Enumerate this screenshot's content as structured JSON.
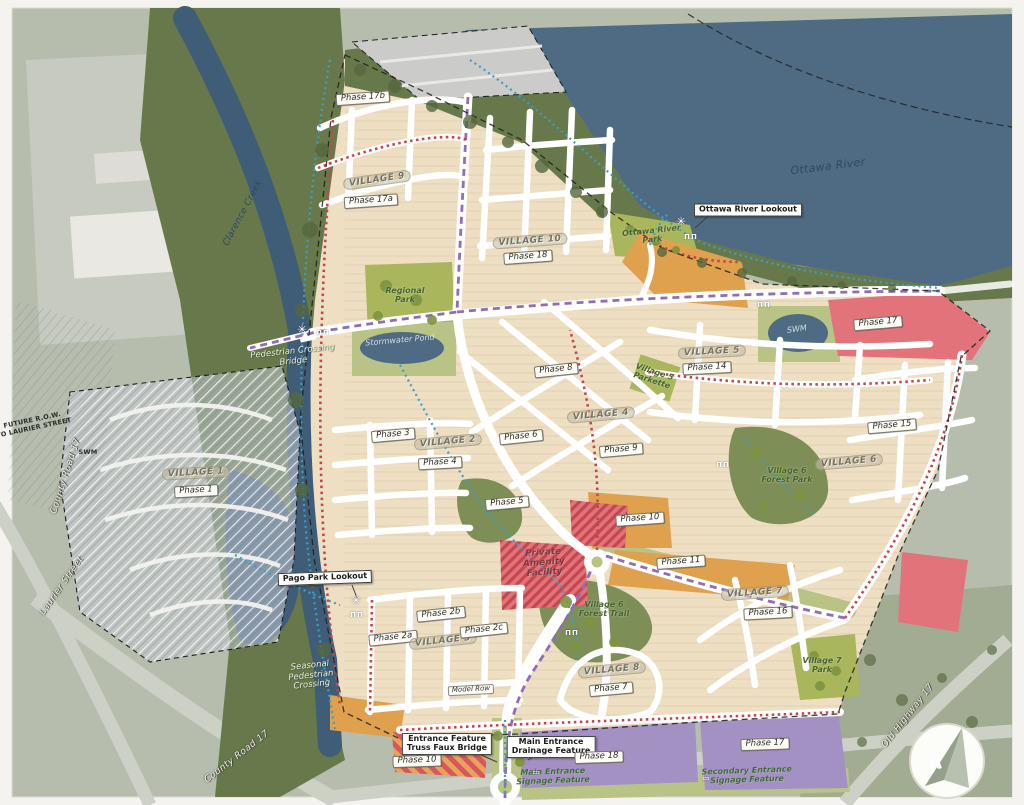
{
  "map": {
    "title": "Community master plan with villages and phases",
    "north_arrow_label": "N",
    "colors": {
      "page": "#f4f3ef",
      "aerial": "#b7bdac",
      "aerial2": "#a2ac92",
      "grayzone": "#c9cbc0",
      "water": "#4e6b83",
      "creek": "#3f5d77",
      "forest": "#67794b",
      "forest2": "#7d8f57",
      "park": "#a9b65b",
      "park2": "#b9c386",
      "site": "#eedfc3",
      "roadwhite": "#ffffff",
      "roadgray": "#cdd1c5",
      "orange": "#dfa14e",
      "pink": "#e2737a",
      "red": "#c2474f",
      "purple": "#a391c4",
      "gray1": "#c6ccd4",
      "trailBlue": "#3e9ec0",
      "trailPurple": "#8f6db8",
      "boundary": "#1d1d1b"
    },
    "labels": [
      {
        "name": "phase-17b-label",
        "text": "Phase 17b",
        "x": 363,
        "y": 98,
        "rot": -4,
        "style": "phase"
      },
      {
        "name": "village-9-label",
        "text": "VILLAGE 9",
        "x": 377,
        "y": 180,
        "rot": -8,
        "style": "village"
      },
      {
        "name": "phase-17a-label",
        "text": "Phase 17a",
        "x": 371,
        "y": 201,
        "rot": -4,
        "style": "phase"
      },
      {
        "name": "clarence-creek-label",
        "text": "Clarence Creek",
        "x": 243,
        "y": 213,
        "rot": -62,
        "style": "water-dark"
      },
      {
        "name": "ottawa-river-label",
        "text": "Ottawa River",
        "x": 828,
        "y": 167,
        "rot": -7,
        "style": "water-dark",
        "size": 11
      },
      {
        "name": "ottawa-river-lookout-callout",
        "text": "Ottawa River Lookout",
        "x": 748,
        "y": 210,
        "rot": 0,
        "style": "callout"
      },
      {
        "name": "ottawa-river-park-label",
        "lines": [
          "Ottawa River",
          "Park"
        ],
        "x": 652,
        "y": 236,
        "rot": -6,
        "style": "park"
      },
      {
        "name": "village-10-label",
        "text": "VILLAGE 10",
        "x": 530,
        "y": 241,
        "rot": -4,
        "style": "village"
      },
      {
        "name": "phase-18-north-label",
        "text": "Phase 18",
        "x": 528,
        "y": 257,
        "rot": -4,
        "style": "phase"
      },
      {
        "name": "regional-park-label",
        "lines": [
          "Regional",
          "Park"
        ],
        "x": 405,
        "y": 296,
        "rot": 0,
        "style": "park"
      },
      {
        "name": "pedestrian-crossing-bridge-label",
        "lines": [
          "Pedestrian Crossing",
          "Bridge"
        ],
        "x": 293,
        "y": 357,
        "rot": -6,
        "style": "note-light"
      },
      {
        "name": "stormwater-pond-label",
        "text": "Stormwater Pond",
        "x": 400,
        "y": 341,
        "rot": -5,
        "style": "water-light"
      },
      {
        "name": "swm-pond-label",
        "text": "SWM",
        "x": 797,
        "y": 330,
        "rot": -8,
        "style": "water-light"
      },
      {
        "name": "swm-west-label",
        "text": "SWM",
        "x": 88,
        "y": 452,
        "rot": 0,
        "style": "tiny-note"
      },
      {
        "name": "phase-17-east-label",
        "text": "Phase 17",
        "x": 878,
        "y": 323,
        "rot": -5,
        "style": "phase"
      },
      {
        "name": "village-5-label",
        "text": "VILLAGE 5",
        "x": 712,
        "y": 352,
        "rot": -3,
        "style": "village"
      },
      {
        "name": "phase-14-label",
        "text": "Phase 14",
        "x": 707,
        "y": 368,
        "rot": -3,
        "style": "phase"
      },
      {
        "name": "phase-8-label",
        "text": "Phase 8",
        "x": 556,
        "y": 370,
        "rot": -6,
        "style": "phase"
      },
      {
        "name": "village-5-parkette-label",
        "lines": [
          "Village 5",
          "Parkette"
        ],
        "x": 653,
        "y": 377,
        "rot": 18,
        "style": "park"
      },
      {
        "name": "village-4-label",
        "text": "VILLAGE 4",
        "x": 601,
        "y": 415,
        "rot": -5,
        "style": "village"
      },
      {
        "name": "phase-3-label",
        "text": "Phase 3",
        "x": 393,
        "y": 435,
        "rot": -5,
        "style": "phase"
      },
      {
        "name": "village-2-label",
        "text": "VILLAGE 2",
        "x": 448,
        "y": 442,
        "rot": -5,
        "style": "village"
      },
      {
        "name": "phase-6-label",
        "text": "Phase 6",
        "x": 521,
        "y": 437,
        "rot": -6,
        "style": "phase"
      },
      {
        "name": "phase-4-label",
        "text": "Phase 4",
        "x": 440,
        "y": 463,
        "rot": -3,
        "style": "phase"
      },
      {
        "name": "phase-9-label",
        "text": "Phase 9",
        "x": 621,
        "y": 450,
        "rot": -5,
        "style": "phase"
      },
      {
        "name": "phase-15-label",
        "text": "Phase 15",
        "x": 892,
        "y": 426,
        "rot": -5,
        "style": "phase"
      },
      {
        "name": "village-6-label",
        "text": "VILLAGE 6",
        "x": 849,
        "y": 462,
        "rot": -5,
        "style": "village"
      },
      {
        "name": "village-6-forest-park-label",
        "lines": [
          "Village 6",
          "Forest Park"
        ],
        "x": 787,
        "y": 476,
        "rot": 0,
        "style": "park"
      },
      {
        "name": "village-1-label",
        "text": "VILLAGE 1",
        "x": 196,
        "y": 473,
        "rot": -3,
        "style": "village"
      },
      {
        "name": "phase-1-label",
        "text": "Phase 1",
        "x": 196,
        "y": 491,
        "rot": -3,
        "style": "phase"
      },
      {
        "name": "phase-5-label",
        "text": "Phase 5",
        "x": 507,
        "y": 503,
        "rot": -5,
        "style": "phase"
      },
      {
        "name": "phase-10-central-label",
        "text": "Phase 10",
        "x": 640,
        "y": 519,
        "rot": -4,
        "style": "phase"
      },
      {
        "name": "private-amenity-facility-label",
        "lines": [
          "Private",
          "Amenity",
          "Facility"
        ],
        "x": 544,
        "y": 563,
        "rot": -4,
        "style": "amenity"
      },
      {
        "name": "phase-11-label",
        "text": "Phase 11",
        "x": 681,
        "y": 562,
        "rot": -4,
        "style": "phase"
      },
      {
        "name": "pago-park-lookout-callout",
        "text": "Pago Park Lookout",
        "x": 325,
        "y": 578,
        "rot": -2,
        "style": "callout"
      },
      {
        "name": "village-7-label",
        "text": "VILLAGE 7",
        "x": 755,
        "y": 593,
        "rot": -4,
        "style": "village"
      },
      {
        "name": "phase-16-label",
        "text": "Phase 16",
        "x": 768,
        "y": 613,
        "rot": -3,
        "style": "phase"
      },
      {
        "name": "phase-2b-label",
        "text": "Phase 2b",
        "x": 441,
        "y": 614,
        "rot": -6,
        "style": "phase"
      },
      {
        "name": "phase-2a-label",
        "text": "Phase 2a",
        "x": 393,
        "y": 638,
        "rot": -6,
        "style": "phase"
      },
      {
        "name": "village-3-label",
        "text": "VILLAGE 3",
        "x": 443,
        "y": 641,
        "rot": -6,
        "style": "village"
      },
      {
        "name": "phase-2c-label",
        "text": "Phase 2c",
        "x": 484,
        "y": 630,
        "rot": -6,
        "style": "phase"
      },
      {
        "name": "seasonal-pedestrian-crossing-label",
        "lines": [
          "Seasonal",
          "Pedestrian",
          "Crossing"
        ],
        "x": 311,
        "y": 676,
        "rot": -6,
        "style": "note-light"
      },
      {
        "name": "village-6-forest-trail-label",
        "lines": [
          "Village 6",
          "Forest Trail"
        ],
        "x": 604,
        "y": 610,
        "rot": 0,
        "style": "park"
      },
      {
        "name": "village-8-label",
        "text": "VILLAGE 8",
        "x": 612,
        "y": 670,
        "rot": -5,
        "style": "village"
      },
      {
        "name": "phase-7-label",
        "text": "Phase 7",
        "x": 611,
        "y": 689,
        "rot": -5,
        "style": "phase"
      },
      {
        "name": "model-row-label",
        "text": "Model Row",
        "x": 471,
        "y": 690,
        "rot": -3,
        "style": "phase-small"
      },
      {
        "name": "village-7-park-label",
        "lines": [
          "Village 7",
          "Park"
        ],
        "x": 822,
        "y": 666,
        "rot": 0,
        "style": "park"
      },
      {
        "name": "entrance-feature-callout",
        "lines": [
          "Entrance Feature",
          "Truss Faux Bridge"
        ],
        "x": 447,
        "y": 744,
        "rot": 0,
        "style": "callout"
      },
      {
        "name": "phase-10-south-label",
        "text": "Phase 10",
        "x": 417,
        "y": 761,
        "rot": -2,
        "style": "phase"
      },
      {
        "name": "main-entrance-drainage-callout",
        "lines": [
          "Main Entrance",
          "Drainage Feature"
        ],
        "x": 551,
        "y": 747,
        "rot": 0,
        "style": "callout"
      },
      {
        "name": "phase-18-south-label",
        "text": "Phase 18",
        "x": 599,
        "y": 757,
        "rot": -2,
        "style": "phase"
      },
      {
        "name": "main-entrance-signage-label",
        "lines": [
          "Main Entrance",
          "Signage Feature"
        ],
        "x": 553,
        "y": 777,
        "rot": -2,
        "style": "entrance"
      },
      {
        "name": "phase-17-south-label",
        "text": "Phase 17",
        "x": 765,
        "y": 744,
        "rot": -2,
        "style": "phase"
      },
      {
        "name": "secondary-entrance-signage-label",
        "lines": [
          "Secondary Entrance",
          "Signage Feature"
        ],
        "x": 747,
        "y": 776,
        "rot": -2,
        "style": "entrance"
      },
      {
        "name": "county-road-17-west-label",
        "text": "County Road 17",
        "x": 66,
        "y": 476,
        "rot": -72,
        "style": "road"
      },
      {
        "name": "laurier-street-label",
        "text": "Laurier Street",
        "x": 62,
        "y": 586,
        "rot": -55,
        "style": "road"
      },
      {
        "name": "county-road-17-south-label",
        "text": "County Road 17",
        "x": 237,
        "y": 757,
        "rot": -38,
        "style": "road"
      },
      {
        "name": "old-highway-17-label",
        "text": "Old Highway 17",
        "x": 908,
        "y": 716,
        "rot": -52,
        "style": "road"
      },
      {
        "name": "future-row-note",
        "lines": [
          "FUTURE R.O.W.",
          "TO LAURIER STREET"
        ],
        "x": 33,
        "y": 424,
        "rot": -12,
        "style": "tiny-note"
      }
    ],
    "icons": [
      {
        "name": "lookout-star-icon",
        "glyph": "✳",
        "cls": "ic-star",
        "x": 302,
        "y": 330
      },
      {
        "name": "picnic-tables-icon",
        "glyph": "ΠΠ",
        "cls": "ic-tables",
        "x": 323,
        "y": 334
      },
      {
        "name": "lookout-star-icon",
        "glyph": "✳",
        "cls": "ic-star",
        "x": 681,
        "y": 222
      },
      {
        "name": "picnic-tables-icon",
        "glyph": "ΠΠ",
        "cls": "ic-tables",
        "x": 691,
        "y": 238
      },
      {
        "name": "lookout-star-icon",
        "glyph": "✳",
        "cls": "ic-star",
        "x": 356,
        "y": 601
      },
      {
        "name": "picnic-tables-icon",
        "glyph": "ΠΠ",
        "cls": "ic-tables",
        "x": 357,
        "y": 616
      },
      {
        "name": "picnic-tables-icon",
        "glyph": "ΠΠ",
        "cls": "ic-tables",
        "x": 723,
        "y": 466
      },
      {
        "name": "picnic-tables-icon",
        "glyph": "ΠΠ",
        "cls": "ic-tables",
        "x": 572,
        "y": 634
      },
      {
        "name": "picnic-tables-icon",
        "glyph": "ΠΠ",
        "cls": "ic-tables",
        "x": 764,
        "y": 306
      },
      {
        "name": "signage-marker-icon",
        "glyph": "▭",
        "cls": "ic-sign",
        "x": 536,
        "y": 773
      },
      {
        "name": "signage-marker-icon",
        "glyph": "▭",
        "cls": "ic-sign",
        "x": 706,
        "y": 779
      }
    ]
  }
}
